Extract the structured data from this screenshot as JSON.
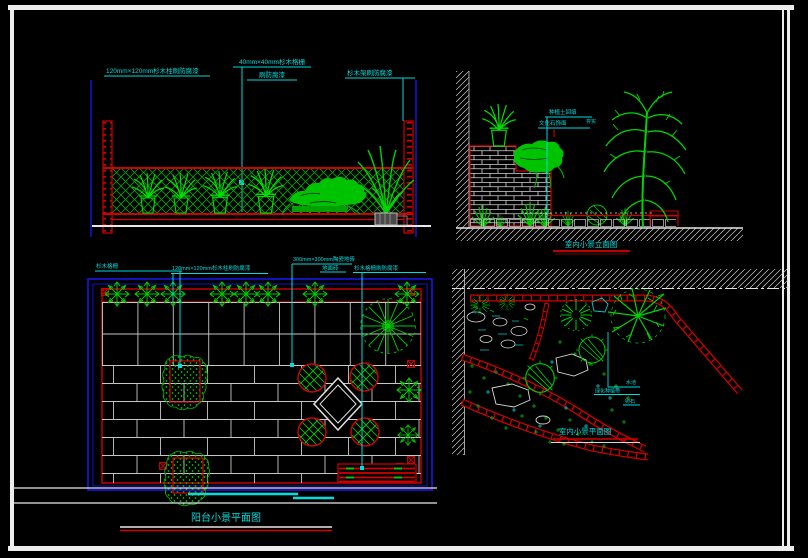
{
  "colors": {
    "background": "#000000",
    "plant_green": "#00cc00",
    "cad_red": "#d40000",
    "annotation_cyan": "#00dddd",
    "frame_blue": "#1515cc",
    "line_white": "#e8e8e8"
  },
  "annotations": {
    "elev_balcony": {
      "post_dim_note": "120mm×120mm杉木柱刷防腐漆",
      "grid_dim_note": "40mm×40mm杉木格栅",
      "grid_paint_note": "刷防腐漆",
      "frame_paint_note": "杉木架刷防腐漆"
    },
    "elev_indoor": {
      "title": "室内小景立面图",
      "soil_note": "种植土回填",
      "soil_sub_note": "夯实",
      "wall_note": "文化石饰面"
    },
    "plan_balcony": {
      "title": "阳台小景平面图",
      "lattice_note": "杉木格栅",
      "post_dim_note": "120mm×120mm杉木柱刷防腐漆",
      "tile_dim_note": "300mm×300mm陶瓷地砖",
      "tile_sub_note": "地面砖",
      "lattice_paint_note": "杉木格栅刷防腐漆"
    },
    "plan_indoor": {
      "title": "室内小景平面图",
      "pool_note": "水池",
      "planting_note": "绿化种植带",
      "pebble_note": "卵石"
    }
  }
}
